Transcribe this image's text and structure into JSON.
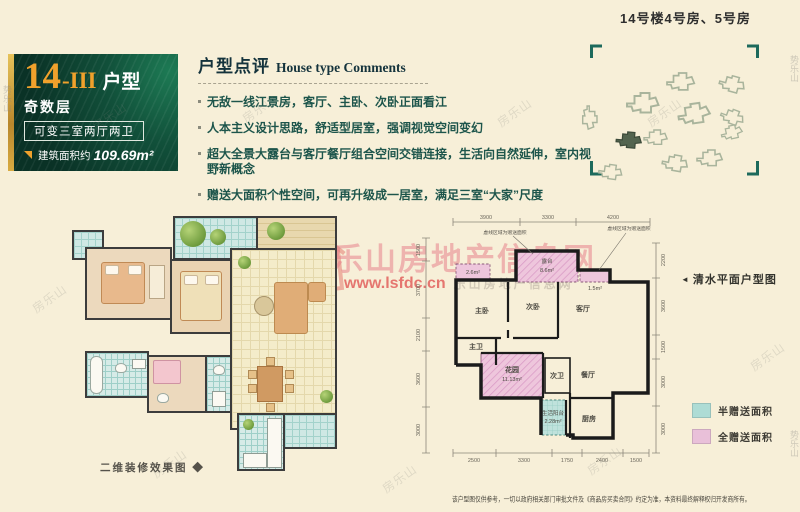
{
  "left_panel": {
    "number": "14",
    "suffix": "-III",
    "type_word": "户型",
    "floor_label": "奇数层",
    "variant_label": "可变三室两厅两卫",
    "stat1_label": "建筑面积约",
    "stat1_value": "109.69m²",
    "stat2_label": "最大可享面积约",
    "stat2_value": "135.84m²"
  },
  "comments": {
    "title_cn": "户型点评",
    "title_en": "House type Comments",
    "items": [
      "无敌一线江景房，客厅、主卧、次卧正面看江",
      "人本主义设计思路，舒适型居室，强调视觉空间变幻",
      "超大全景大露台与客厅餐厅组合空间交错连接，生活向自然延伸，室内视野新概念",
      "赠送大面积个性空间，可再升级成一居室，满足三室“大家”尺度"
    ]
  },
  "site_plan": {
    "title": "14号楼4号房、5号房"
  },
  "render_plan": {
    "caption": "二维装修效果图 ◆"
  },
  "floor_plan": {
    "caption_pointer": "◄",
    "caption": "清水平面户型图",
    "annotation_left": "虚线区域为赠送面积",
    "annotation_right": "虚线区域为赠送面积",
    "rooms": {
      "master_bed": "主卧",
      "second_bed": "次卧",
      "living": "客厅",
      "master_bath": "主卫",
      "garden": "花园",
      "garden_area": "11.13m²",
      "second_bath": "次卫",
      "dining": "餐厅",
      "service_balcony": "生活阳台",
      "service_balcony_area": "2.28m²",
      "kitchen": "厨房",
      "terrace": "露台",
      "terrace_area": "8.6m²",
      "bay_left_area": "2.6m²",
      "bay_right_area": "1.5m²"
    },
    "dims_top": [
      "3900",
      "3300",
      "4200"
    ],
    "dims_bottom": [
      "2500",
      "3300",
      "1750",
      "2400",
      "1500"
    ],
    "dims_left": [
      "1500",
      "3700",
      "2100",
      "3600",
      "3000"
    ],
    "dims_right": [
      "2200",
      "3600",
      "1500",
      "3000",
      "3000"
    ],
    "legend": [
      {
        "label": "半赠送面积",
        "color": "#aedcd5"
      },
      {
        "label": "全赠送面积",
        "color": "#e9c0d9"
      }
    ]
  },
  "watermark": {
    "site_name": "乐山房地产信息网",
    "url": "www.lsfdc.cn",
    "url_tail": "乐山房地产信息网",
    "scatter_mark": "房乐山",
    "edge_mark": "势乐山"
  },
  "disclaimer": "该户型图仅供参考，一切以政府相关部门审批文件及《商品房买卖合同》约定为准，本资料最终解释权归开发商所有。",
  "colors": {
    "accent_orange": "#f0a12c",
    "panel_green": "#0e4a38",
    "half_gift_teal": "#aedcd5",
    "full_gift_pink": "#e9c0d9",
    "watermark_red": "#de4646",
    "background": "#f7efd8"
  }
}
